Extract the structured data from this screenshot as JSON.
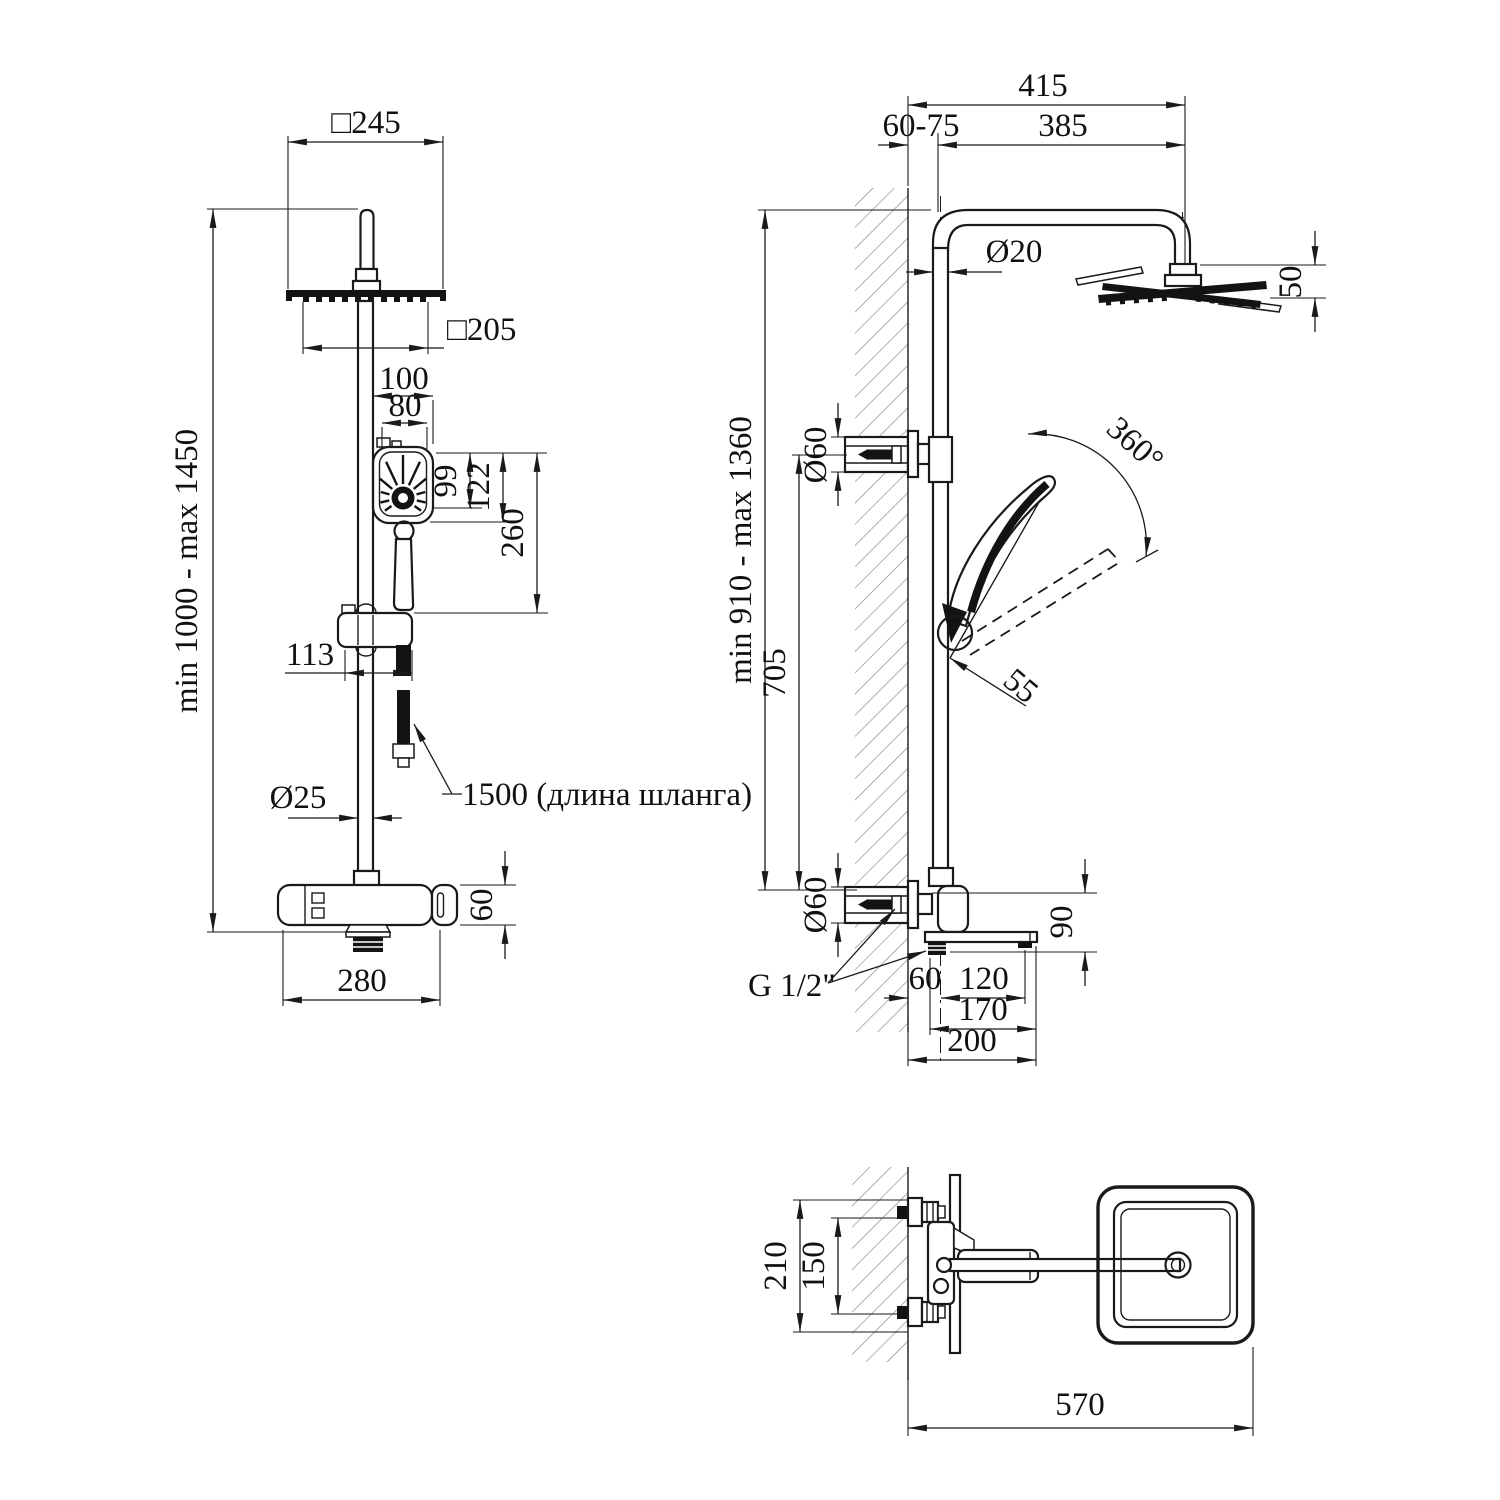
{
  "drawing": {
    "type": "shower-system-installation-drawing",
    "line_color": "#1a1a1a",
    "background": "#ffffff"
  },
  "views": {
    "front": {
      "dims": {
        "overall_square": "□245",
        "face_square": "□205",
        "hand_width": "100",
        "hand_face_width": "80",
        "spray_height": "99",
        "head_height": "122",
        "hand_assembly_height": "260",
        "slider_offset": "113",
        "pipe_diameter": "Ø25",
        "hose_length": "1500 (длина шланга)",
        "mixer_height": "60",
        "mixer_width": "280",
        "height_range": "min 1000 - max 1450"
      }
    },
    "side": {
      "dims": {
        "arm_reach": "415",
        "wall_offset": "60-75",
        "arm_length": "385",
        "pipe_diameter": "Ø20",
        "head_thickness": "50",
        "height_range": "min 910 - max 1360",
        "bracket_spacing": "705",
        "bracket_diameter_top": "Ø60",
        "bracket_diameter_bottom": "Ø60",
        "handshower_swivel": "360°",
        "holder_offset": "55",
        "spout_height": "90",
        "thread_size": "G 1/2\"",
        "wall_to_pole": "60",
        "pole_to_drain": "120",
        "spout_reach": "170",
        "total_reach": "200"
      }
    },
    "top": {
      "dims": {
        "body_depth": "210",
        "connection_spacing": "150",
        "total_depth": "570"
      }
    }
  }
}
